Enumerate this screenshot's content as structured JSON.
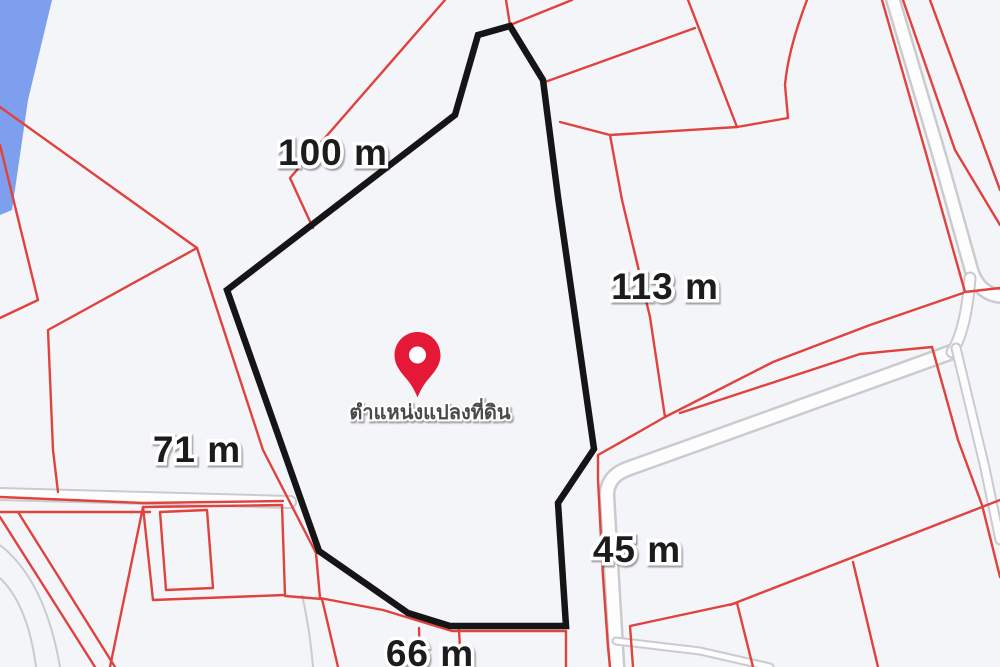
{
  "map": {
    "measurements": {
      "north": "100 m",
      "east": "113 m",
      "west": "71 m",
      "south_east": "45 m",
      "south": "66 m"
    },
    "pin": {
      "icon": "map-pin",
      "label": "ตำแหน่งแปลงที่ดิน"
    },
    "colors": {
      "background": "#F4F5F8",
      "water": "#7D9FEE",
      "parcel-line": "#E0423E",
      "plot-outline": "#151515",
      "pin": "#E51937",
      "road-edge": "#C9CBCE",
      "road-fill": "#FDFDFE",
      "label-text": "#1B1B1B",
      "pin-label-text": "#4A4A4A"
    }
  }
}
